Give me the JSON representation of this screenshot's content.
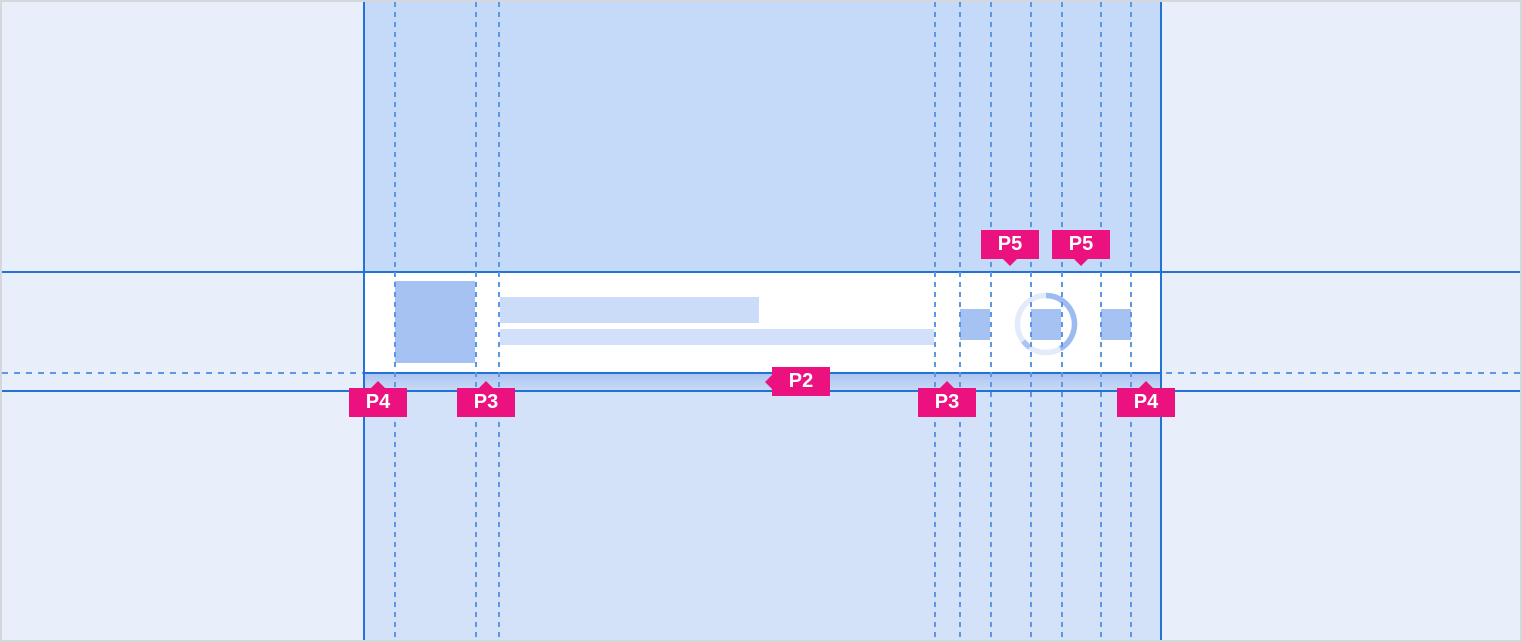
{
  "spec": {
    "component": "list-item-row-spacing-spec",
    "annotations": {
      "padding_left_outer": "P4",
      "padding_after_avatar": "P3",
      "padding_vertical_bottom": "P2",
      "padding_before_actions": "P3",
      "padding_action_gap_1": "P5",
      "padding_action_gap_2": "P5",
      "padding_right_outer": "P4"
    },
    "placeholders": {
      "avatar": "avatar-placeholder",
      "title": "title-line-placeholder",
      "subtitle": "subtitle-line-placeholder",
      "action_1": "action-icon-placeholder",
      "action_2": "action-icon-placeholder",
      "action_3": "action-icon-placeholder",
      "spinner": "loading-spinner-icon"
    },
    "colors": {
      "canvas_background": "#e9eefb",
      "column_background_top": "#c5daf8",
      "column_background_bottom": "#d3e1f9",
      "row_background": "#ffffff",
      "placeholder_strong": "#a5c2f3",
      "placeholder_soft": "#cbdcf8",
      "placeholder_softer": "#d2e0f9",
      "guide_solid": "#2273d8",
      "guide_dashed": "#5c97e5",
      "band_gradient_top": "#a9c3ee",
      "band_gradient_bottom": "#cbdcf8",
      "annotation_background": "#eb1280",
      "annotation_text": "#ffffff",
      "frame_border": "#d4d7db"
    },
    "guides": {
      "vertical_dashed_x": [
        392,
        473,
        496,
        932,
        957,
        988,
        1028,
        1059,
        1098,
        1128
      ],
      "vertical_solid_x": [
        361,
        1159
      ],
      "horizontal_solid_y": [
        269,
        370,
        388
      ],
      "horizontal_dashed_y": [
        370
      ]
    }
  }
}
